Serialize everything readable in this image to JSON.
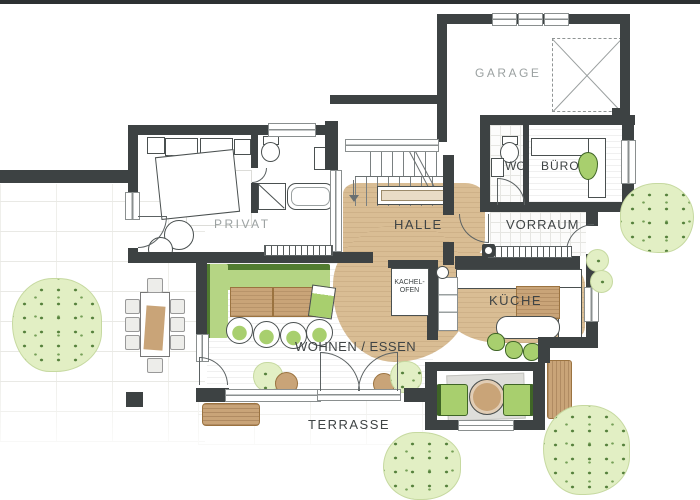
{
  "floorplan": {
    "type": "ground-floor architectural plan",
    "labels": {
      "garage": "GARAGE",
      "wc": "WC",
      "buero": "BÜRO",
      "privat": "PRIVAT",
      "halle": "HALLE",
      "vorraum": "VORRAUM",
      "kachelofen_line1": "KACHEL-",
      "kachelofen_line2": "OFEN",
      "kueche": "KÜCHE",
      "wohnen_essen": "WOHNEN / ESSEN",
      "terrasse": "TERRASSE"
    },
    "colors": {
      "wall": "#3d4243",
      "wood_floor": "#d9bd94",
      "furniture_wood": "#c9a478",
      "upholstery_green": "#a8cf6e",
      "sofa_green_dark": "#517c30",
      "foliage_fill": "#e2efc4",
      "foliage_accent": "#55813c",
      "label_muted": "#9ba1a1",
      "label_dark": "#3f4445",
      "paving_joint": "#e9e9e5"
    }
  }
}
